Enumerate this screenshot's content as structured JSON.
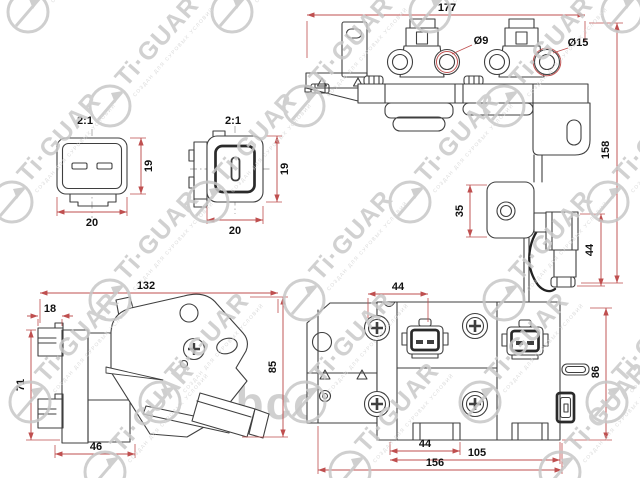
{
  "watermark": {
    "brand": "Ti·GUAR",
    "tagline": "СОЗДАН ДЛЯ СУРОВЫХ УСЛОВИЙ",
    "site_overlay": "abco.ru"
  },
  "drawing": {
    "line_color": "#3f3f3f",
    "dimension_color": "#bf4f4f"
  },
  "views": {
    "connector_a": {
      "scale": "2:1",
      "dim_width": "20",
      "dim_height": "19"
    },
    "connector_b": {
      "scale": "2:1",
      "dim_width": "20",
      "dim_height": "19"
    },
    "front": {
      "dim_width": "177",
      "dim_height": "158",
      "dia_small": "Ø9",
      "dia_large": "Ø15",
      "dim_bracket": "35",
      "dim_boot": "44"
    },
    "side": {
      "dim_width": "132",
      "dim_tab": "18",
      "dim_height": "71",
      "dim_base": "46",
      "dim_overall": "85"
    },
    "bottom": {
      "dim_pitch": "44",
      "dim_lower": "44",
      "dim_span": "105",
      "dim_width": "156",
      "dim_height": "86"
    }
  }
}
